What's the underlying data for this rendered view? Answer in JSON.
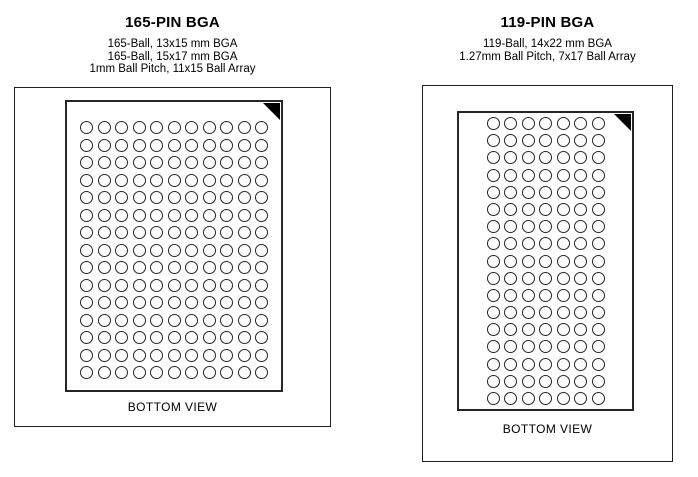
{
  "page": {
    "background": "#ffffff"
  },
  "packages": [
    {
      "title": "165-PIN BGA",
      "subtitle_lines": [
        "165-Ball, 13x15 mm BGA",
        "165-Ball, 15x17 mm BGA",
        "1mm Ball Pitch, 11x15 Ball Array"
      ],
      "grid": {
        "rows": 15,
        "cols": 11,
        "total_balls": 165
      },
      "view_label": "BOTTOM VIEW"
    },
    {
      "title": "119-PIN BGA",
      "subtitle_lines": [
        "119-Ball, 14x22 mm BGA",
        "1.27mm Ball Pitch, 7x17 Ball Array"
      ],
      "grid": {
        "rows": 17,
        "cols": 7,
        "total_balls": 119
      },
      "view_label": "BOTTOM VIEW"
    }
  ],
  "icons": {
    "pin1_marker": "corner-triangle"
  },
  "colors": {
    "line": "#1f1f1f",
    "background": "#ffffff",
    "ball_fill": "#ffffff",
    "pin1_marker": "#000000"
  }
}
